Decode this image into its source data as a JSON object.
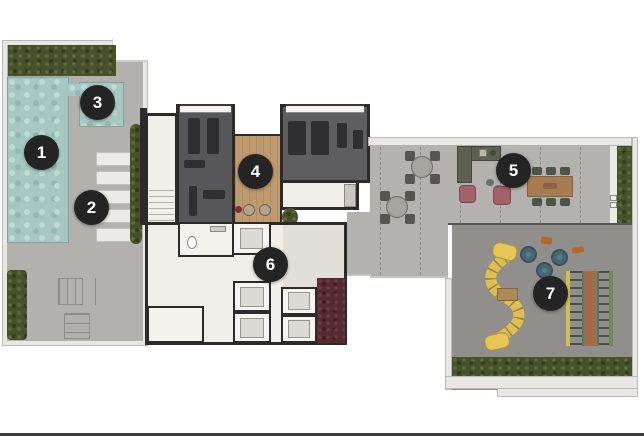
{
  "plan": {
    "markers": [
      {
        "label": "1"
      },
      {
        "label": "2"
      },
      {
        "label": "3"
      },
      {
        "label": "4"
      },
      {
        "label": "5"
      },
      {
        "label": "6"
      },
      {
        "label": "7"
      }
    ]
  },
  "colors": {
    "marker_bg": "#242424",
    "marker_text": "#ffffff",
    "pool_water": "#a7c8c2",
    "deck": "#b2b1ad",
    "hedge_green": "#46512c",
    "gym_floor": "#57575a",
    "wood_floor": "#bf9a6e",
    "core_floor": "#f1efe9",
    "terrace_floor": "#b4b2ae",
    "playground_floor": "#908f8b",
    "vertical_garden_red": "#572a30",
    "slide_yellow": "#e0bf50",
    "wall_dark": "#2c2b29",
    "armchair_pink": "#a2626a",
    "dining_table_wood": "#a87c52"
  }
}
